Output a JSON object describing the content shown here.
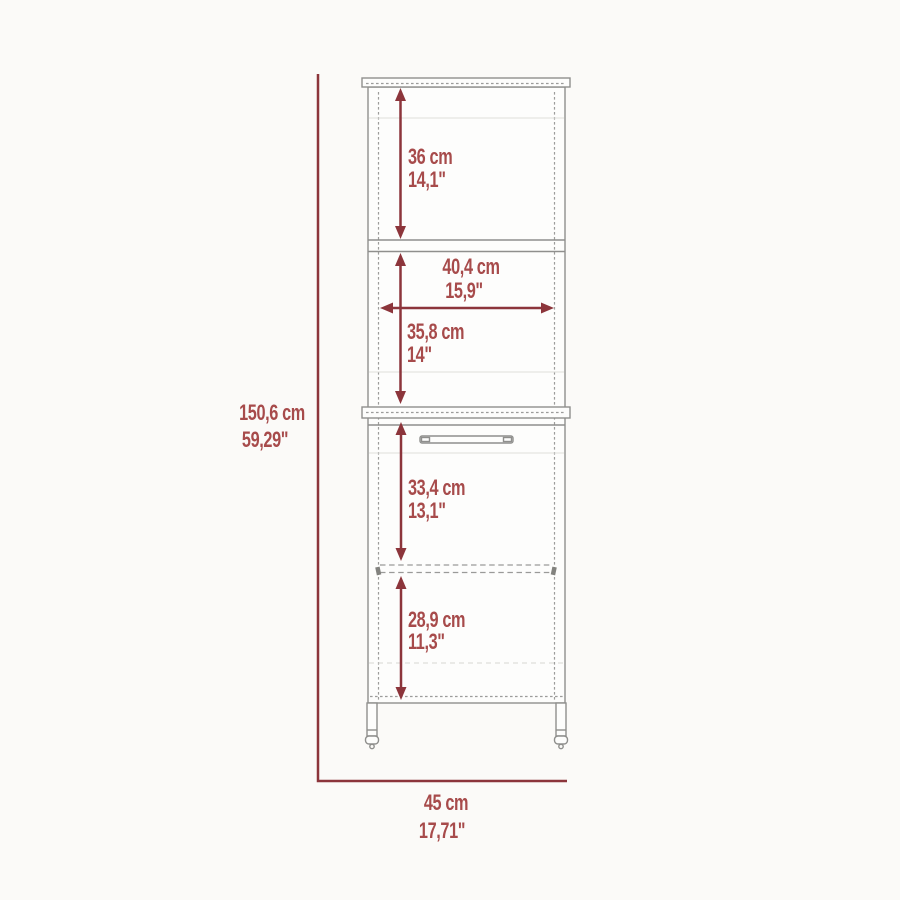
{
  "diagram": {
    "kind": "furniture-dimension-drawing",
    "subject": "tall cabinet with upper open shelves and lower door, front elevation",
    "colors": {
      "dimension_line": "#8c353b",
      "dimension_text": "#a74b4b",
      "cabinet_outline": "#8f8f8d",
      "background": "#fbfaf8"
    },
    "dimensions": {
      "upper_shelf_height": {
        "cm": "36 cm",
        "inches": "14,1\""
      },
      "interior_width": {
        "cm": "40,4 cm",
        "inches": "15,9\""
      },
      "middle_section_height": {
        "cm": "35,8 cm",
        "inches": "14\""
      },
      "overall_height": {
        "cm": "150,6 cm",
        "inches": "59,29\""
      },
      "door_upper_section_height": {
        "cm": "33,4 cm",
        "inches": "13,1\""
      },
      "door_lower_section_height": {
        "cm": "28,9 cm",
        "inches": "11,3\""
      },
      "overall_width": {
        "cm": "45 cm",
        "inches": "17,71\""
      }
    }
  }
}
